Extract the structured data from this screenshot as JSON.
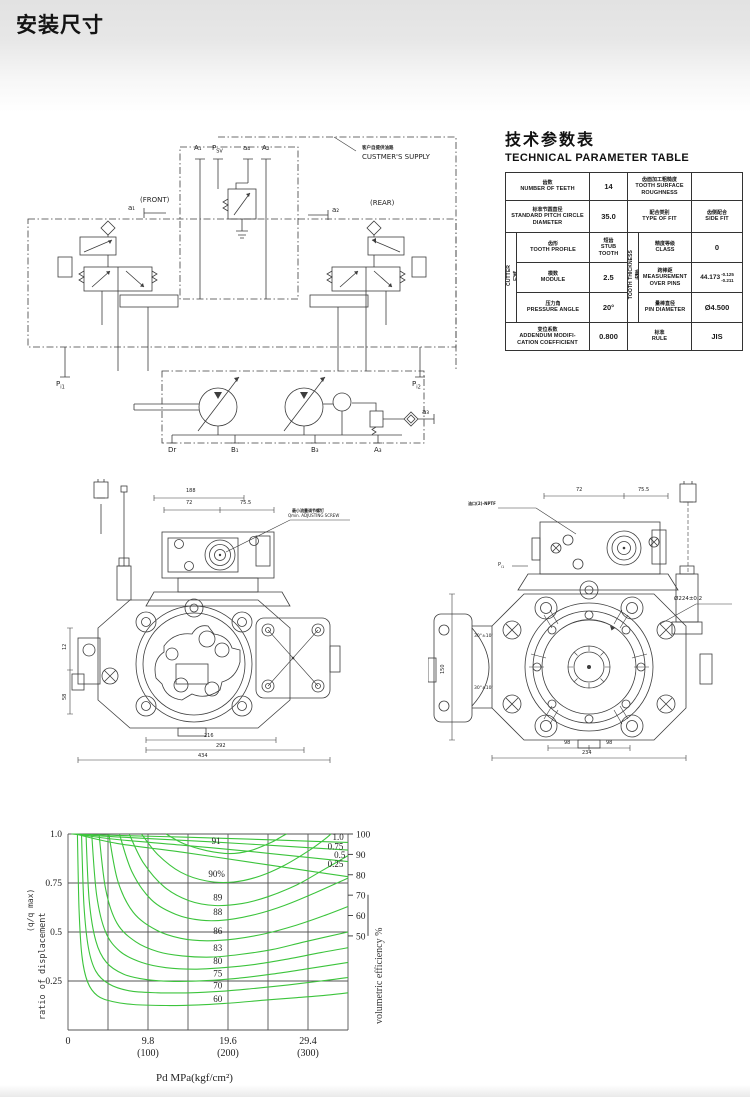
{
  "header": {
    "title": "安装尺寸"
  },
  "schematic": {
    "supply_zh": "客户自提供油路",
    "supply_en": "CUSTMER'S SUPPLY",
    "front": "(FRONT)",
    "rear": "(REAR)",
    "ports": {
      "a1t": "A₁",
      "psv_m": "P",
      "psv_s": "SV",
      "a4": "a₄",
      "a2t": "A₂",
      "a1": "a₁",
      "a2": "a₂",
      "pi_m": "P",
      "pi1_s": "i1",
      "pi2_s": "i2",
      "dr": "Dr",
      "b1": "B₁",
      "b3": "B₃",
      "a3t": "A₃",
      "a3": "a₃"
    }
  },
  "param_table": {
    "title_zh": "技术参数表",
    "title_en": "TECHNICAL PARAMETER TABLE",
    "teeth_zh": "齿数",
    "teeth_en": "NUMBER OF TEETH",
    "teeth_val": "14",
    "rough_zh": "齿面加工粗糙度",
    "rough_en": "TOOTH SURFACE ROUGHNESS",
    "rough_val": "",
    "pitch_zh": "标准节圆直径",
    "pitch_en": "STANDARD PITCH CIRCLE DIAMETER",
    "pitch_val": "35.0",
    "fit_zh": "配合类别",
    "fit_en": "TYPE OF FIT",
    "fit_val_zh": "齿侧配合",
    "fit_val_en": "SIDE FIT",
    "cutter_zh": "刀具",
    "cutter_en": "CUTTER",
    "thick_zh": "齿厚",
    "thick_en": "TOOTH THICKNESS",
    "profile_zh": "齿形",
    "profile_en": "TOOTH PROFILE",
    "profile_val_zh": "短齿",
    "profile_val_en": "STUB TOOTH",
    "class_zh": "精度等级",
    "class_en": "CLASS",
    "class_val": "0",
    "module_zh": "模数",
    "module_en": "MODULE",
    "module_val": "2.5",
    "mop_zh": "跨棒距",
    "mop_en": "MEASUREMENT OVER PINS",
    "mop_val": "44.173",
    "mop_tol_up": "-0.125",
    "mop_tol_dn": "-0.211",
    "angle_zh": "压力角",
    "angle_en": "PRESSURE ANGLE",
    "angle_val": "20°",
    "pin_zh": "量棒直径",
    "pin_en": "PIN DIAMETER",
    "pin_val": "Ø4.500",
    "add_zh": "变位系数",
    "add_en1": "ADDENDUM MODIFI-",
    "add_en2": "CATION COEFFICIENT",
    "add_val": "0.800",
    "rule_zh": "标准",
    "rule_en": "RULE",
    "rule_val": "JIS"
  },
  "drawings": {
    "left": {
      "dim_188": "188",
      "dim_72": "72",
      "dim_755": "75.5",
      "screw_zh": "最小流量调节螺钉",
      "screw_en": "Qmin. ADJUSTING SCREW",
      "dim_216": "216",
      "dim_292": "292",
      "dim_434": "434",
      "dim_12": "12",
      "dim_58": "58"
    },
    "right": {
      "dim_72": "72",
      "dim_755": "75.5",
      "port_label": "油口(2)-NPTF",
      "pi_m": "P",
      "pi_s": "i1",
      "dia": "Ø224±0.2",
      "ang1": "30°±10'",
      "ang2": "30°±10'",
      "dim_98a": "98",
      "dim_98b": "98",
      "dim_234": "234",
      "dim_150": "150"
    }
  },
  "chart_data": {
    "type": "line",
    "xlabel_line1": "Pd  MPa(kgf/cm²)",
    "xlabel_line2": "delivery pressure",
    "ylabel_left_line1": "(q/q max)",
    "ylabel_left_line2": "ratio of displacement",
    "ylabel_right": "volumetric efficiency %",
    "xlim": [
      0,
      34.3
    ],
    "ylim": [
      0,
      1.0
    ],
    "grid_x_step": 4.9,
    "grid_y_step": 0.25,
    "grid_on": true,
    "line_color": "#3cc43c",
    "x_ticks": [
      {
        "v": 0,
        "l1": "0",
        "l2": ""
      },
      {
        "v": 9.8,
        "l1": "9.8",
        "l2": "(100)"
      },
      {
        "v": 19.6,
        "l1": "19.6",
        "l2": "(200)"
      },
      {
        "v": 29.4,
        "l1": "29.4",
        "l2": "(300)"
      }
    ],
    "y_ticks_left": [
      1.0,
      0.75,
      0.5,
      0.25
    ],
    "y_ticks_left_labels": [
      "1.0",
      "0.75",
      "0.5",
      "0.25"
    ],
    "right_axis": {
      "values": [
        100,
        90,
        80,
        70,
        60,
        50
      ],
      "top_y": 1.0,
      "bottom_y": 0.48
    },
    "series": [
      {
        "name": "eff-60",
        "points": [
          [
            1.15,
            1.0
          ],
          [
            1.35,
            0.62
          ],
          [
            1.7,
            0.38
          ],
          [
            2.4,
            0.245
          ],
          [
            3.6,
            0.175
          ],
          [
            5.5,
            0.145
          ],
          [
            8,
            0.13
          ],
          [
            12,
            0.125
          ],
          [
            16,
            0.128
          ],
          [
            20,
            0.138
          ],
          [
            24,
            0.152
          ],
          [
            28,
            0.165
          ],
          [
            31,
            0.175
          ],
          [
            34.3,
            0.19
          ]
        ]
      },
      {
        "name": "eff-70",
        "points": [
          [
            1.65,
            1.0
          ],
          [
            1.95,
            0.64
          ],
          [
            2.5,
            0.42
          ],
          [
            3.4,
            0.3
          ],
          [
            5,
            0.235
          ],
          [
            7.5,
            0.2
          ],
          [
            11,
            0.19
          ],
          [
            15,
            0.19
          ],
          [
            19,
            0.198
          ],
          [
            23,
            0.213
          ],
          [
            27,
            0.23
          ],
          [
            31,
            0.25
          ],
          [
            34.3,
            0.268
          ]
        ]
      },
      {
        "name": "eff-75",
        "points": [
          [
            2.2,
            1.0
          ],
          [
            2.6,
            0.66
          ],
          [
            3.4,
            0.455
          ],
          [
            4.7,
            0.345
          ],
          [
            6.8,
            0.285
          ],
          [
            9.5,
            0.258
          ],
          [
            13,
            0.248
          ],
          [
            17,
            0.252
          ],
          [
            21,
            0.265
          ],
          [
            25,
            0.285
          ],
          [
            29,
            0.31
          ],
          [
            34.3,
            0.345
          ]
        ]
      },
      {
        "name": "eff-80",
        "points": [
          [
            2.9,
            1.0
          ],
          [
            3.5,
            0.69
          ],
          [
            4.6,
            0.5
          ],
          [
            6.4,
            0.4
          ],
          [
            9,
            0.345
          ],
          [
            12,
            0.318
          ],
          [
            15.5,
            0.31
          ],
          [
            19,
            0.318
          ],
          [
            23,
            0.335
          ],
          [
            27,
            0.363
          ],
          [
            31,
            0.395
          ],
          [
            34.3,
            0.42
          ]
        ]
      },
      {
        "name": "eff-83",
        "points": [
          [
            3.8,
            1.0
          ],
          [
            4.6,
            0.72
          ],
          [
            6,
            0.545
          ],
          [
            8.3,
            0.45
          ],
          [
            11,
            0.4
          ],
          [
            14,
            0.378
          ],
          [
            17.5,
            0.372
          ],
          [
            21,
            0.385
          ],
          [
            25,
            0.41
          ],
          [
            29,
            0.45
          ],
          [
            34.3,
            0.5
          ]
        ]
      },
      {
        "name": "eff-86",
        "points": [
          [
            5.0,
            1.0
          ],
          [
            6.1,
            0.76
          ],
          [
            8,
            0.6
          ],
          [
            10.8,
            0.51
          ],
          [
            13.8,
            0.468
          ],
          [
            17,
            0.455
          ],
          [
            20.5,
            0.465
          ],
          [
            24,
            0.49
          ],
          [
            28,
            0.535
          ],
          [
            31.5,
            0.585
          ],
          [
            34.3,
            0.63
          ]
        ]
      },
      {
        "name": "eff-88",
        "points": [
          [
            6.3,
            1.0
          ],
          [
            7.8,
            0.81
          ],
          [
            10.2,
            0.665
          ],
          [
            13.2,
            0.59
          ],
          [
            16.3,
            0.56
          ],
          [
            19.5,
            0.562
          ],
          [
            23,
            0.59
          ],
          [
            26.5,
            0.635
          ],
          [
            30,
            0.695
          ],
          [
            34.3,
            0.775
          ]
        ]
      },
      {
        "name": "eff-89",
        "points": [
          [
            7.5,
            1.0
          ],
          [
            9.2,
            0.855
          ],
          [
            11.8,
            0.73
          ],
          [
            14.8,
            0.66
          ],
          [
            18,
            0.635
          ],
          [
            21.3,
            0.645
          ],
          [
            24.5,
            0.68
          ],
          [
            28,
            0.74
          ],
          [
            31,
            0.81
          ],
          [
            34.3,
            0.89
          ]
        ]
      },
      {
        "name": "eff-90",
        "points": [
          [
            9.0,
            1.0
          ],
          [
            11,
            0.895
          ],
          [
            13.8,
            0.805
          ],
          [
            17,
            0.76
          ],
          [
            20.3,
            0.755
          ],
          [
            23.5,
            0.785
          ],
          [
            26.5,
            0.84
          ],
          [
            29.5,
            0.915
          ],
          [
            31.5,
            0.975
          ],
          [
            32.2,
            1.0
          ]
        ]
      },
      {
        "name": "eff-91",
        "points": [
          [
            12.0,
            1.0
          ],
          [
            14.2,
            0.95
          ],
          [
            17,
            0.915
          ],
          [
            19.8,
            0.9
          ],
          [
            22.3,
            0.915
          ],
          [
            24.8,
            0.955
          ],
          [
            26.3,
            0.99
          ],
          [
            26.8,
            1.0
          ]
        ]
      },
      {
        "name": "ratio-1.0",
        "points": [
          [
            0.4,
            1.0
          ],
          [
            6,
            0.993
          ],
          [
            14,
            0.984
          ],
          [
            22,
            0.974
          ],
          [
            30,
            0.963
          ],
          [
            34.3,
            0.957
          ]
        ]
      },
      {
        "name": "ratio-0.75",
        "points": [
          [
            0.55,
            1.0
          ],
          [
            6,
            0.985
          ],
          [
            14,
            0.968
          ],
          [
            22,
            0.949
          ],
          [
            30,
            0.929
          ],
          [
            34.3,
            0.918
          ]
        ]
      },
      {
        "name": "ratio-0.5",
        "points": [
          [
            0.7,
            1.0
          ],
          [
            6,
            0.972
          ],
          [
            14,
            0.943
          ],
          [
            22,
            0.912
          ],
          [
            30,
            0.878
          ],
          [
            34.3,
            0.859
          ]
        ]
      },
      {
        "name": "ratio-0.25",
        "points": [
          [
            0.9,
            1.0
          ],
          [
            6,
            0.952
          ],
          [
            14,
            0.907
          ],
          [
            22,
            0.858
          ],
          [
            30,
            0.808
          ],
          [
            34.3,
            0.782
          ]
        ]
      }
    ],
    "labels": [
      {
        "text": "91",
        "x": 17.6,
        "y": 0.965
      },
      {
        "text": "90%",
        "x": 17.2,
        "y": 0.795
      },
      {
        "text": "89",
        "x": 17.8,
        "y": 0.675
      },
      {
        "text": "88",
        "x": 17.8,
        "y": 0.603
      },
      {
        "text": "86",
        "x": 17.8,
        "y": 0.505
      },
      {
        "text": "83",
        "x": 17.8,
        "y": 0.418
      },
      {
        "text": "80",
        "x": 17.8,
        "y": 0.352
      },
      {
        "text": "75",
        "x": 17.8,
        "y": 0.288
      },
      {
        "text": "70",
        "x": 17.8,
        "y": 0.226
      },
      {
        "text": "60",
        "x": 17.8,
        "y": 0.158
      },
      {
        "text": "1.0",
        "x": 32.4,
        "y": 0.985
      },
      {
        "text": "0.75",
        "x": 31.8,
        "y": 0.937
      },
      {
        "text": "0.5",
        "x": 32.6,
        "y": 0.893
      },
      {
        "text": "0.25",
        "x": 31.8,
        "y": 0.848
      }
    ]
  }
}
